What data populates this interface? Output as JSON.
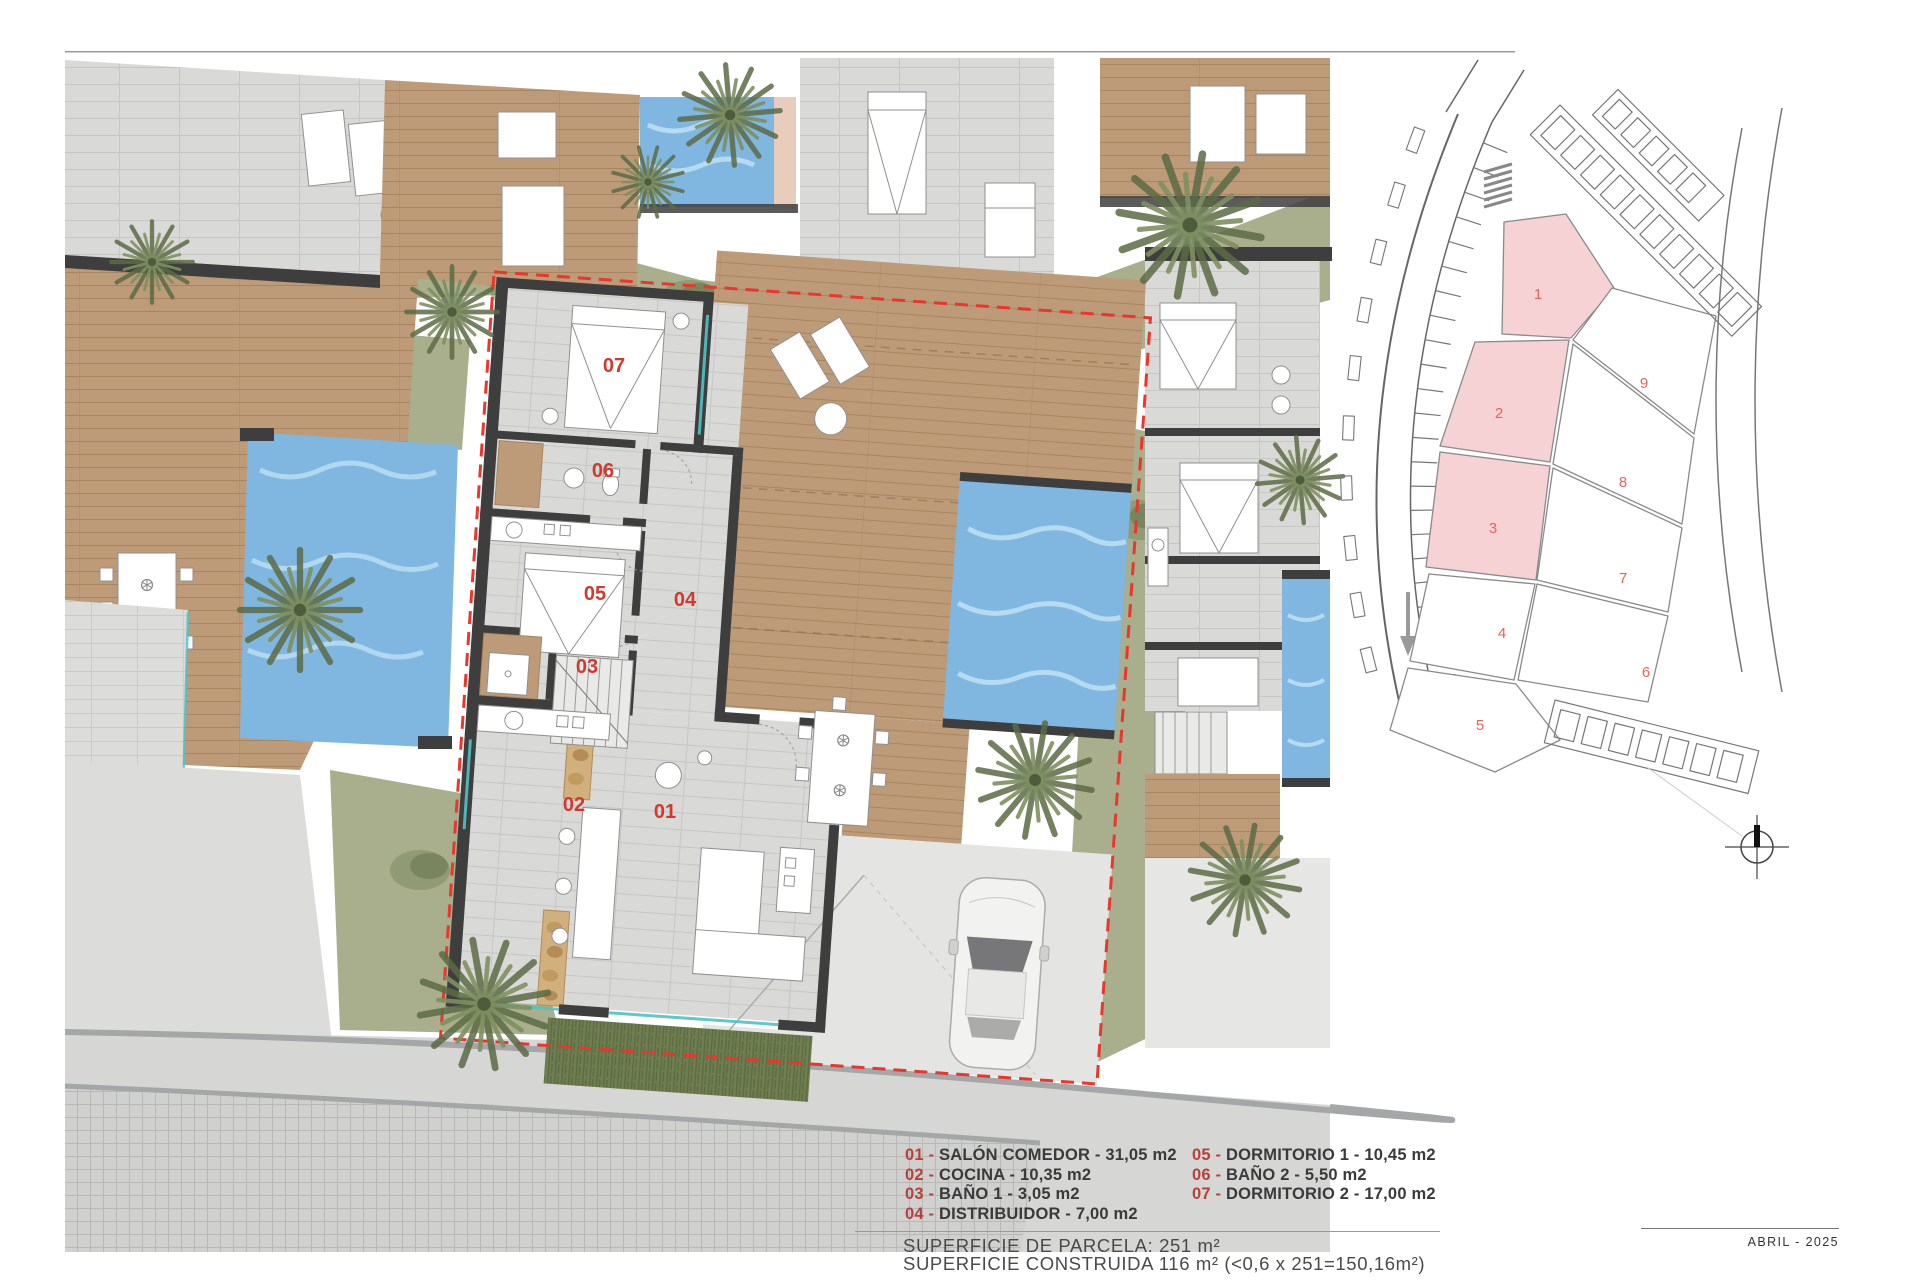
{
  "legend": {
    "items": [
      {
        "num": "01",
        "label": "SALÓN COMEDOR - 31,05 m2"
      },
      {
        "num": "02",
        "label": "COCINA - 10,35 m2"
      },
      {
        "num": "03",
        "label": "BAÑO 1 - 3,05 m2"
      },
      {
        "num": "04",
        "label": "DISTRIBUIDOR - 7,00 m2"
      },
      {
        "num": "05",
        "label": "DORMITORIO 1 - 10,45 m2"
      },
      {
        "num": "06",
        "label": "BAÑO 2 - 5,50 m2"
      },
      {
        "num": "07",
        "label": "DORMITORIO 2 - 17,00 m2"
      }
    ]
  },
  "summary": {
    "parcel": "SUPERFICIE DE PARCELA: 251 m²",
    "built": "SUPERFICIE CONSTRUIDA 116 m² (<0,6 x 251=150,16m²)"
  },
  "footer": {
    "date": "ABRIL - 2025"
  },
  "floorplan": {
    "room_labels": [
      "01",
      "02",
      "03",
      "04",
      "05",
      "06",
      "07"
    ]
  },
  "site_map": {
    "plots": [
      {
        "num": "1",
        "highlighted": true
      },
      {
        "num": "2",
        "highlighted": true
      },
      {
        "num": "3",
        "highlighted": true
      },
      {
        "num": "4",
        "highlighted": false
      },
      {
        "num": "5",
        "highlighted": false
      },
      {
        "num": "6",
        "highlighted": false
      },
      {
        "num": "7",
        "highlighted": false
      },
      {
        "num": "8",
        "highlighted": false
      },
      {
        "num": "9",
        "highlighted": false
      }
    ],
    "highlighted_plots": [
      "1",
      "2",
      "3"
    ]
  },
  "colors": {
    "accent_red": "#CE3A2E",
    "legend_red": "#B5413C",
    "plot_pink": "#F6D2D4",
    "pool_blue": "#7FB7E0",
    "wood": "#BE9B78",
    "grass": "#A9AE8C"
  }
}
